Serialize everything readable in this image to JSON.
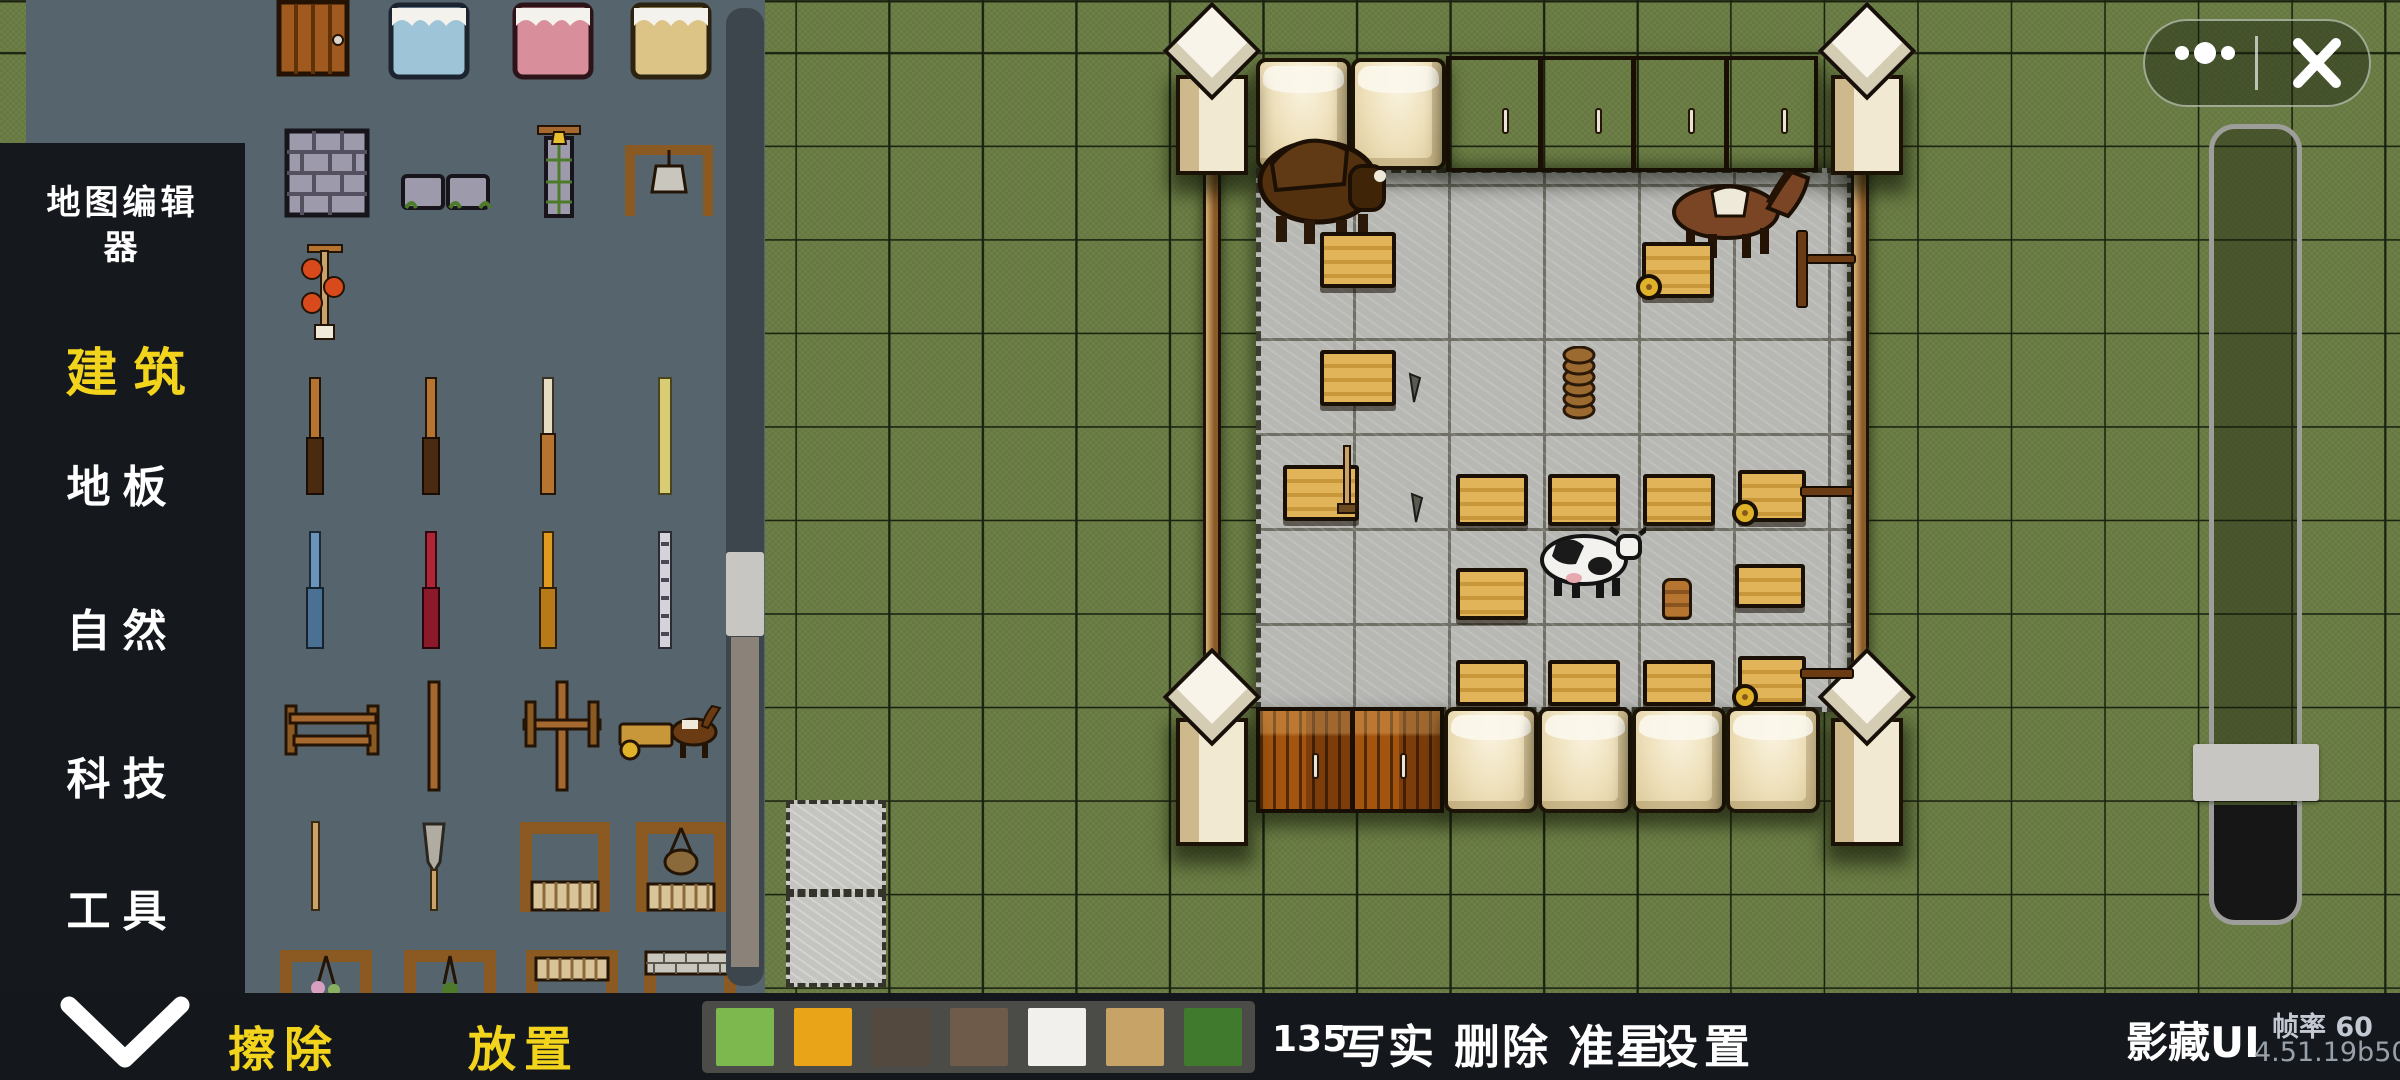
{
  "app": {
    "hide_ui_label": "影藏UI",
    "fps_label": "帧率 60",
    "version": "4.51.19b50",
    "accent_yellow": "#f2d41c",
    "panel_slate": "#56656d",
    "grass_green": "#6d7f46"
  },
  "sidebar": {
    "title": "地图编辑器",
    "categories": [
      {
        "label": "建筑",
        "selected": true
      },
      {
        "label": "地板",
        "selected": false
      },
      {
        "label": "自然",
        "selected": false
      },
      {
        "label": "科技",
        "selected": false
      },
      {
        "label": "工具",
        "selected": false
      }
    ]
  },
  "palette": {
    "items": [
      "wood-door",
      "bed-blue",
      "bed-pink",
      "bed-yellow",
      "stone-wall",
      "stone-wall-low",
      "bell-tower",
      "hanging-bell-frame",
      "lantern-pole",
      "wood-pole",
      "wood-pole-2",
      "tan-pole",
      "yellow-pole",
      "blue-pole",
      "red-pole",
      "orange-pole",
      "bone-pole",
      "wood-fence",
      "tall-post",
      "cross-post",
      "horse-cart",
      "wood-stick",
      "spade",
      "wood-frame",
      "basket-frame",
      "flower-frame",
      "plant-frame",
      "wood-gate",
      "stone-gate"
    ]
  },
  "toolbar": {
    "collapse_icon": "chevron-down-icon",
    "erase_label": "擦除",
    "place_label": "放置",
    "map_code": "135",
    "tools": [
      "写实",
      "删除",
      "准星",
      "设置"
    ],
    "tools_line_a": "写实 删除 准星",
    "tools_line_b": "设置",
    "swatches": [
      {
        "name": "grass-light",
        "color": "#7db84e"
      },
      {
        "name": "orange-ground",
        "color": "#e9a418"
      },
      {
        "name": "dark-rock",
        "color": "#53493f"
      },
      {
        "name": "mixed-stone",
        "color": "#6f5b49"
      },
      {
        "name": "white-tile",
        "color": "#f1f0ec"
      },
      {
        "name": "sand",
        "color": "#c7a368"
      },
      {
        "name": "grass-dark",
        "color": "#3f7a2d"
      }
    ]
  },
  "capsule": {
    "more_icon": "more-dots-icon",
    "close_icon": "close-x-icon"
  },
  "map": {
    "animals": [
      "bison",
      "horse",
      "cow"
    ],
    "objects": [
      "workbench",
      "log-cart",
      "barrel",
      "plate-stack",
      "hoe",
      "awl",
      "corner-tower",
      "plank-wall",
      "cream-wall",
      "fence-pole",
      "stone-floor",
      "stray-stone-tiles"
    ]
  }
}
